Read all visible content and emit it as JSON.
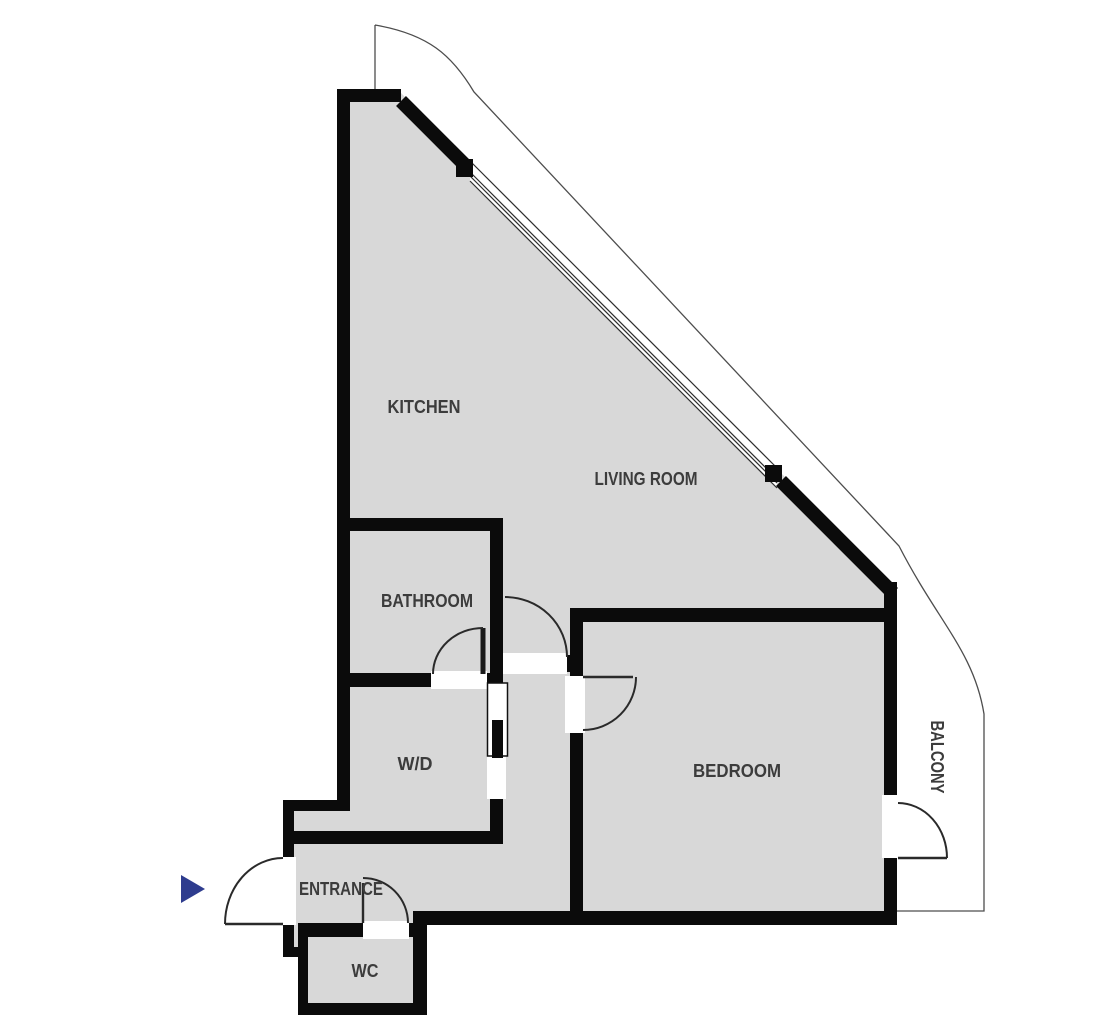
{
  "floorplan": {
    "rooms": {
      "kitchen": {
        "label": "KITCHEN"
      },
      "living_room": {
        "label": "LIVING ROOM"
      },
      "bathroom": {
        "label": "BATHROOM"
      },
      "wd": {
        "label": "W/D"
      },
      "bedroom": {
        "label": "BEDROOM"
      },
      "entrance": {
        "label": "ENTRANCE"
      },
      "wc": {
        "label": "WC"
      },
      "balcony": {
        "label": "BALCONY"
      }
    },
    "colors": {
      "floor": "#d8d8d8",
      "wall": "#0b0b0b",
      "outline": "#4d4d4d",
      "label": "#3c3c3c",
      "entrance_marker": "#2e3c8e"
    }
  }
}
